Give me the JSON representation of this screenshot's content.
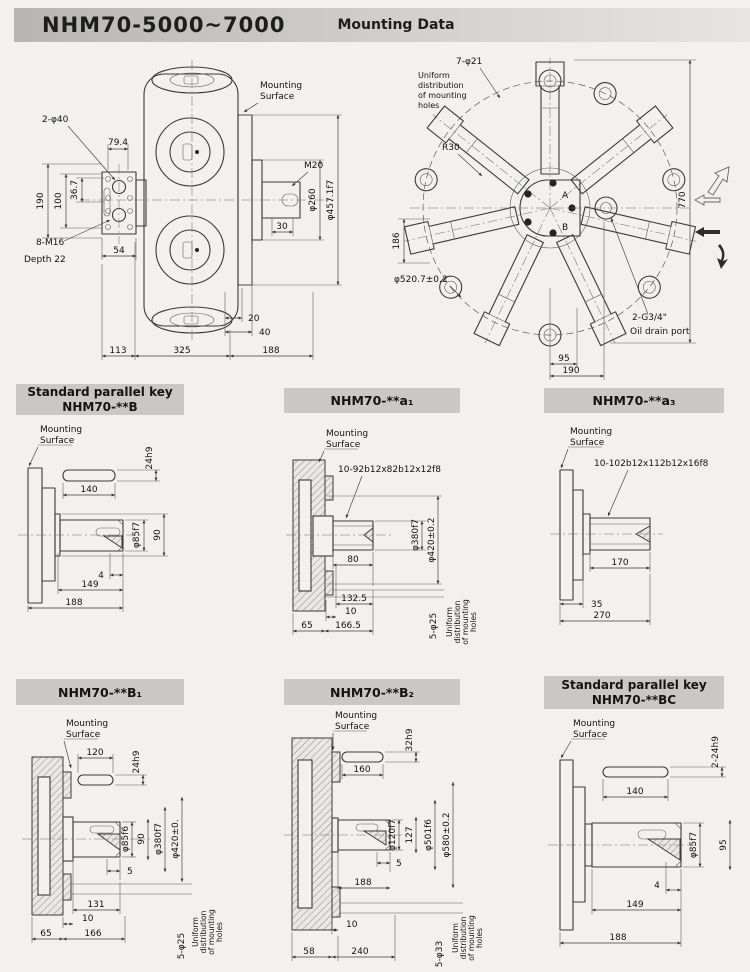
{
  "header": {
    "model": "NHM70-5000~7000",
    "subtitle": "Mounting Data"
  },
  "common": {
    "mounting1": "Mounting",
    "mounting2": "Surface",
    "uniform1": "Uniform",
    "uniform2": "distribution",
    "uniform3": "of mounting",
    "uniform4": "holes"
  },
  "side_view": {
    "pilot_holes": "2-φ40",
    "d79": "79.4",
    "d36": "36.7",
    "d100": "100",
    "d190": "190",
    "bolts": "8-M16",
    "depth": "Depth 22",
    "d54": "54",
    "thread": "M20",
    "d260": "φ260",
    "d457": "φ457.1f7",
    "d30": "30",
    "d20": "20",
    "d40": "40",
    "d113": "113",
    "d325": "325",
    "d188": "188"
  },
  "front_view": {
    "holes": "7-φ21",
    "r30": "R30",
    "d186": "186",
    "d520": "φ520.7±0.2",
    "d770": "770",
    "d95": "95",
    "d190": "190",
    "drain": "2-G3/4\"",
    "drain_label": "Oil drain port",
    "port_a": "A",
    "port_b": "B"
  },
  "panel_b": {
    "title1": "Standard parallel key",
    "title2": "NHM70-**B",
    "key_len": "140",
    "key_h": "24h9",
    "shaft_d": "φ85f7",
    "d90": "90",
    "d4": "4",
    "d149": "149",
    "d188": "188"
  },
  "panel_a1": {
    "title": "NHM70-**a₁",
    "spline": "10-92b12x82b12x12f8",
    "shaft_d": "φ380f7",
    "pilot_d": "φ420±0.2",
    "d80": "80",
    "d132": "132.5",
    "d10": "10",
    "d65": "65",
    "d166": "166.5",
    "holes": "5-φ25"
  },
  "panel_a3": {
    "title": "NHM70-**a₃",
    "spline": "10-102b12x112b12x16f8",
    "d170": "170",
    "d35": "35",
    "d270": "270"
  },
  "panel_b1": {
    "title": "NHM70-**B₁",
    "key_len": "120",
    "key_h": "24h9",
    "shaft_d": "φ85f6",
    "d90": "90",
    "pilot_d": "φ380f7",
    "flange_d": "φ420±0.",
    "d5": "5",
    "d131": "131",
    "d10": "10",
    "d65": "65",
    "d166": "166",
    "holes": "5-φ25"
  },
  "panel_b2": {
    "title": "NHM70-**B₂",
    "key_len": "160",
    "key_h": "32h9",
    "shaft_d": "φ120f7",
    "d127": "127",
    "pilot_d": "φ501f6",
    "flange_d": "φ580±0.2",
    "d5": "5",
    "d188": "188",
    "d10": "10",
    "d58": "58",
    "d240": "240",
    "holes": "5-φ33"
  },
  "panel_bc": {
    "title1": "Standard parallel key",
    "title2": "NHM70-**BC",
    "key_len": "140",
    "key_h": "2-24h9",
    "shaft_d": "φ85f7",
    "d95": "95",
    "d4": "4",
    "d149": "149",
    "d188": "188"
  }
}
